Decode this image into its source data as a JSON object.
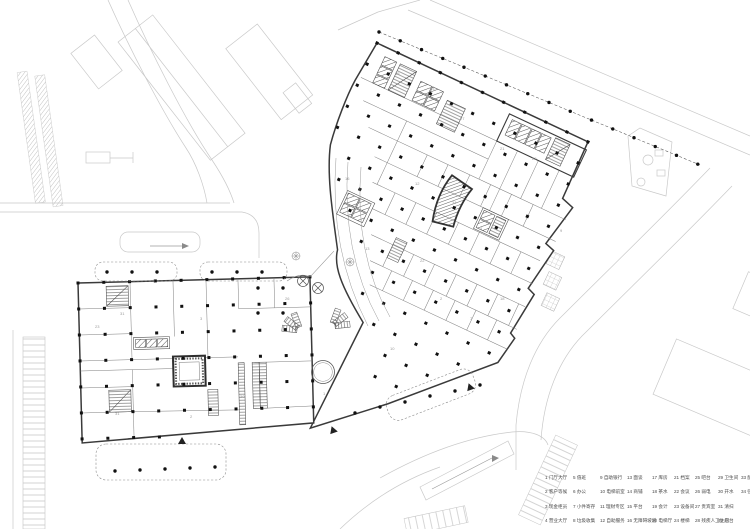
{
  "title": "first-floor-plan",
  "colors": {
    "paper": "#ffffff",
    "wall": "#3a3a3a",
    "partition": "#7d7d7d",
    "context": "#c9c9c9",
    "column": "#111111",
    "hatch": "#555555",
    "legend_text": "#4a4a4a"
  },
  "legend": {
    "items": [
      "1 门厅大厅",
      "2 客户等候",
      "3 现金柜员",
      "4 营业大厅",
      "5 值班",
      "6 办公",
      "7 小件寄存",
      "8 垃圾收集",
      "9 自助银行",
      "10 电梯前室",
      "11 理财专区",
      "12 自助服务",
      "13 面谈",
      "14 商铺",
      "15 平台",
      "16 无障碍坡道",
      "17 库房",
      "18 茶水",
      "19 会计",
      "20 电梯厅",
      "21 档案",
      "22 会议",
      "23 设备间",
      "24 楼梯",
      "25 吧台",
      "26 弱电",
      "27 贵宾室",
      "28 残疾人卫生间",
      "29 卫生间",
      "30 开水",
      "31 清扫",
      "32 后台",
      "33 配电",
      "34 强电"
    ]
  },
  "plan": {
    "room_labels": [
      "35",
      "33",
      "27",
      "21",
      "12",
      "34",
      "4",
      "29",
      "9",
      "22",
      "2",
      "7",
      "13",
      "16",
      "10",
      "31",
      "23",
      "3",
      "18",
      "31",
      "2",
      "30",
      "26",
      "1"
    ]
  }
}
